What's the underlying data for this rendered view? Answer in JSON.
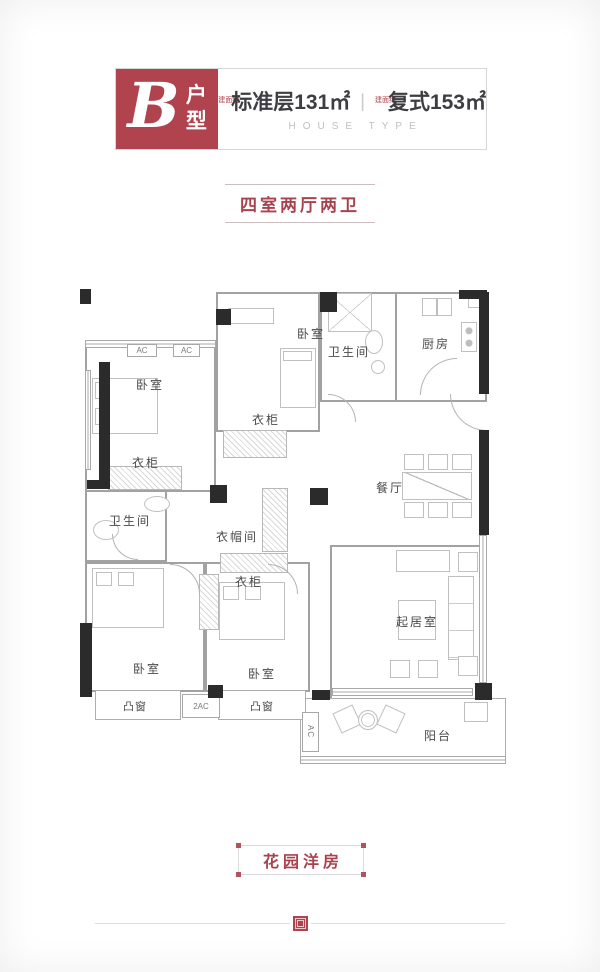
{
  "colors": {
    "brand_red": "#b0434e",
    "text_dark": "#3e3d42",
    "wall_gray": "#a2a2a2",
    "column_black": "#2b2b2b"
  },
  "header": {
    "type_letter": "B",
    "type_word_top": "户",
    "type_word_bottom": "型",
    "area_note": "建面约",
    "area_standard": "标准层131㎡",
    "separator": "|",
    "area_duplex": "复式153㎡",
    "subtitle_en": "HOUSE TYPE"
  },
  "layout_badge": "四室两厅两卫",
  "plan": {
    "labels": {
      "bedroom": "卧室",
      "bathroom": "卫生间",
      "kitchen": "厨房",
      "wardrobe": "衣柜",
      "cloakroom": "衣帽间",
      "dining": "餐厅",
      "living": "起居室",
      "bay_window": "凸窗",
      "balcony": "阳台",
      "ac": "AC",
      "ac_double": "2AC"
    }
  },
  "footer": {
    "project_badge": "花园洋房"
  }
}
